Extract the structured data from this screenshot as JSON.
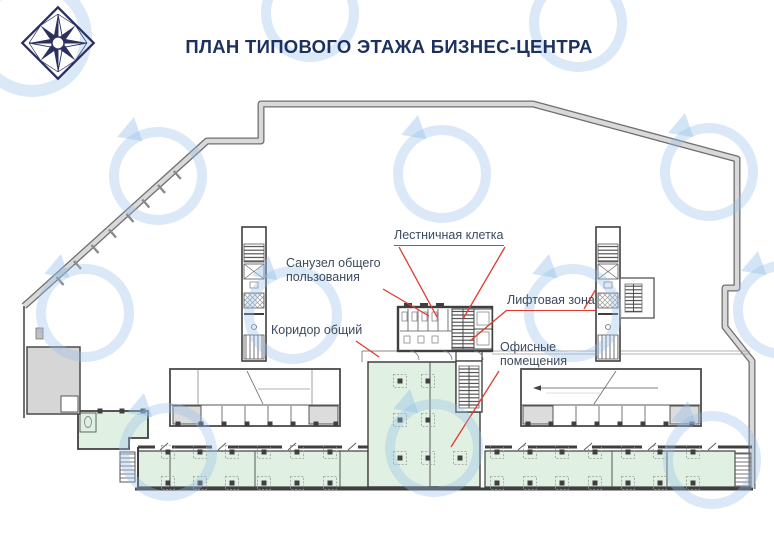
{
  "header": {
    "title": "ПЛАН ТИПОВОГО ЭТАЖА БИЗНЕС-ЦЕНТРА"
  },
  "branding": {
    "logo_icon": "diamond-compass-rose-logo",
    "watermark_icon": "circular-swirl-logo-watermark"
  },
  "annotations": {
    "label_color": "#3c4b5d",
    "leader_color": "#e13a2c",
    "labels": [
      {
        "id": "staircase",
        "text": "Лестничная клетка"
      },
      {
        "id": "shared-bathroom",
        "text": "Санузел общего пользования"
      },
      {
        "id": "elevator-zone",
        "text": "Лифтовая зона"
      },
      {
        "id": "common-corridor",
        "text": "Коридор общий"
      },
      {
        "id": "offices",
        "text": "Офисные помещения"
      }
    ]
  },
  "plan": {
    "colors": {
      "office_room_fill": "#e0f1e3",
      "terrace_fill": "#d6d6d6",
      "wall_dark": "#4a4a4a",
      "wall_band": "#d9d9d9",
      "watermark_blue": "#94bee8",
      "title_navy": "#1d3160"
    }
  }
}
